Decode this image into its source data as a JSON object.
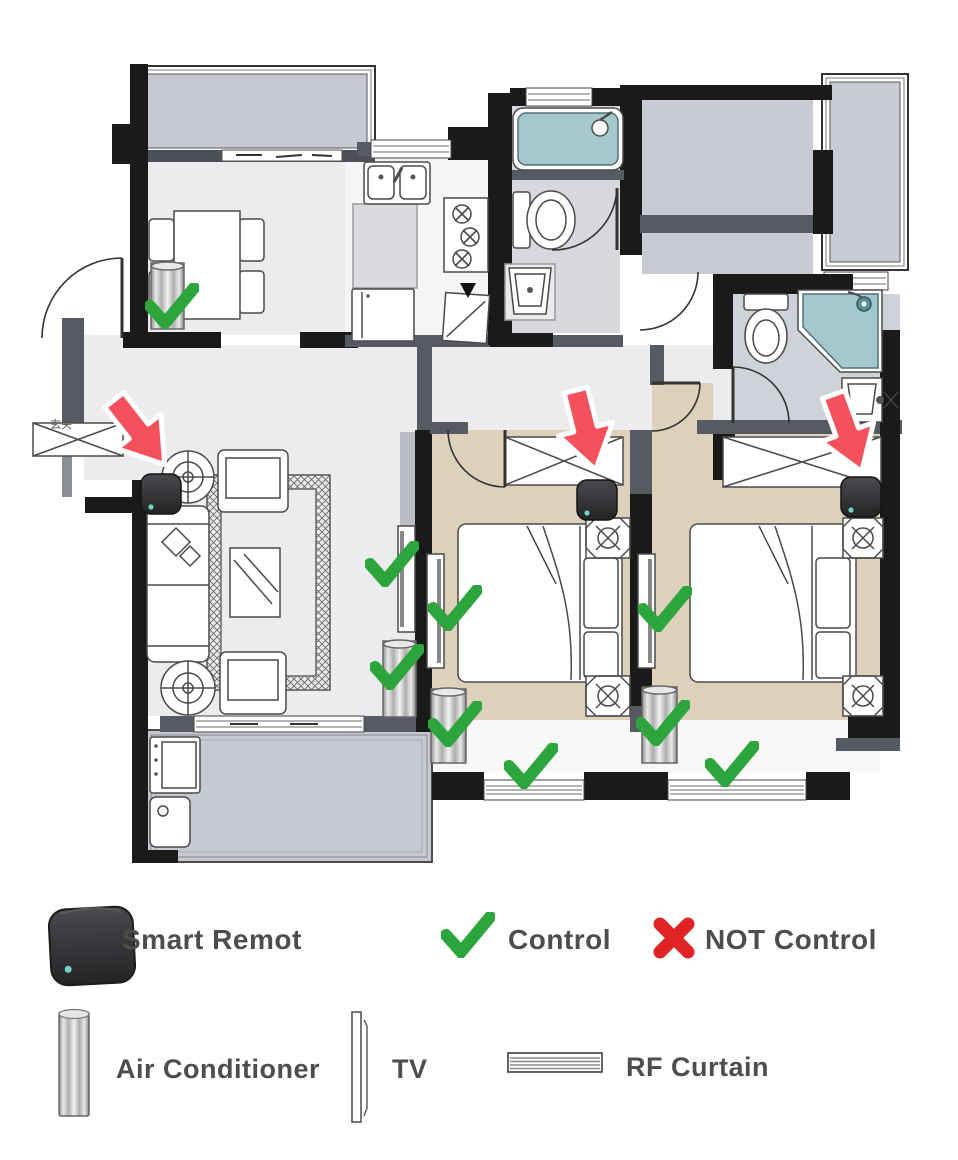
{
  "floor_plan": {
    "entry_label": "玄关",
    "colors": {
      "control_check": "#2ca53c",
      "arrow_red": "#f4515c",
      "not_control_x": "#e02424",
      "bedroom_floor": "#ddd1bc",
      "balcony_floor": "#c6c8d2",
      "living_floor": "#ececee",
      "fixture_teal": "#a4c8cc"
    },
    "devices": {
      "smart_remotes": [
        {
          "room": "living-room",
          "x": 161,
          "y": 494
        },
        {
          "room": "bedroom-1",
          "x": 597,
          "y": 500
        },
        {
          "room": "bedroom-2",
          "x": 861,
          "y": 497
        }
      ],
      "arrows": [
        {
          "room": "living-room",
          "x": 140,
          "y": 433,
          "rotation": -38
        },
        {
          "room": "bedroom-1",
          "x": 586,
          "y": 431,
          "rotation": -14
        },
        {
          "room": "bedroom-2",
          "x": 848,
          "y": 434,
          "rotation": -20
        }
      ],
      "control_checks": [
        {
          "target": "dining-ac",
          "x": 172,
          "y": 306
        },
        {
          "target": "living-tv",
          "x": 392,
          "y": 564
        },
        {
          "target": "living-ac",
          "x": 397,
          "y": 667
        },
        {
          "target": "bedroom1-tv",
          "x": 455,
          "y": 608
        },
        {
          "target": "bedroom1-ac",
          "x": 455,
          "y": 724
        },
        {
          "target": "bedroom1-curtain",
          "x": 531,
          "y": 766
        },
        {
          "target": "bedroom2-tv",
          "x": 665,
          "y": 609
        },
        {
          "target": "bedroom2-ac",
          "x": 663,
          "y": 723
        },
        {
          "target": "bedroom2-curtain",
          "x": 732,
          "y": 764
        }
      ]
    }
  },
  "legend": {
    "smart_remote": {
      "label": "Smart Remot"
    },
    "control": {
      "label": "Control"
    },
    "not_control": {
      "label": "NOT Control"
    },
    "air_conditioner": {
      "label": "Air Conditioner"
    },
    "tv": {
      "label": "TV"
    },
    "rf_curtain": {
      "label": "RF Curtain"
    }
  }
}
